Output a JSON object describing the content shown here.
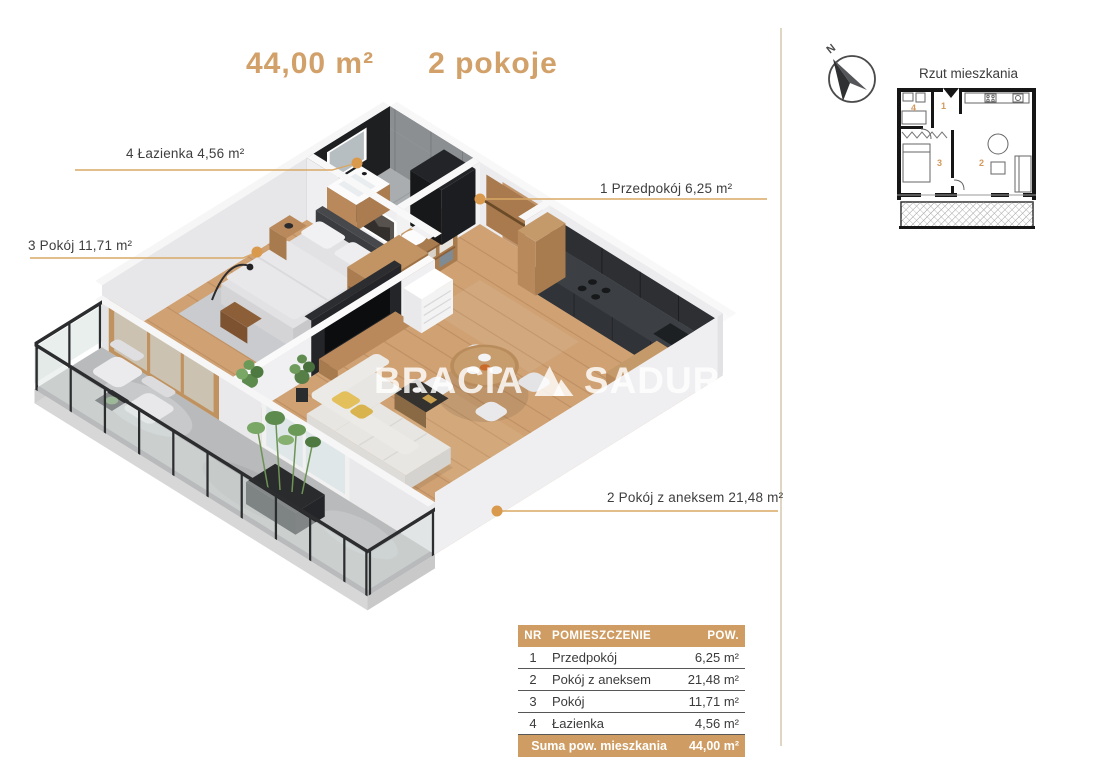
{
  "header": {
    "area": "44,00 m²",
    "rooms_count": "2 pokoje"
  },
  "watermark": {
    "part1": "BRACIA",
    "part2": "SADURS",
    "logo": "double-triangle"
  },
  "plan_labels": [
    {
      "nr": "4",
      "text": "4 Łazienka 4,56 m²"
    },
    {
      "nr": "1",
      "text": "1 Przedpokój 6,25 m²"
    },
    {
      "nr": "3",
      "text": "3 Pokój 11,71 m²"
    },
    {
      "nr": "2",
      "text": "2 Pokój z aneksem 21,48 m²"
    }
  ],
  "side_panel": {
    "compass_n": "N",
    "mini_plan_title": "Rzut mieszkania",
    "mini_plan_room_numbers": [
      "4",
      "1",
      "3",
      "2"
    ]
  },
  "table": {
    "headers": {
      "nr": "NR",
      "name": "POMIESZCZENIE",
      "area": "POW."
    },
    "rows": [
      {
        "nr": "1",
        "name": "Przedpokój",
        "area": "6,25 m²"
      },
      {
        "nr": "2",
        "name": "Pokój z aneksem",
        "area": "21,48 m²"
      },
      {
        "nr": "3",
        "name": "Pokój",
        "area": "11,71 m²"
      },
      {
        "nr": "4",
        "name": "Łazienka",
        "area": "4,56 m²"
      }
    ],
    "footer": {
      "label": "Suma pow. mieszkania",
      "value": "44,00 m²"
    }
  },
  "colors": {
    "accent": "#cf9d63",
    "leader_line": "#d9a865",
    "text": "#3e3e3e",
    "watermark": "rgba(255,255,255,0.82)",
    "wood_floor": "#cfa173",
    "bathroom_wall": "#1e1f21",
    "kitchen_cabinets": "#2d2f32"
  }
}
